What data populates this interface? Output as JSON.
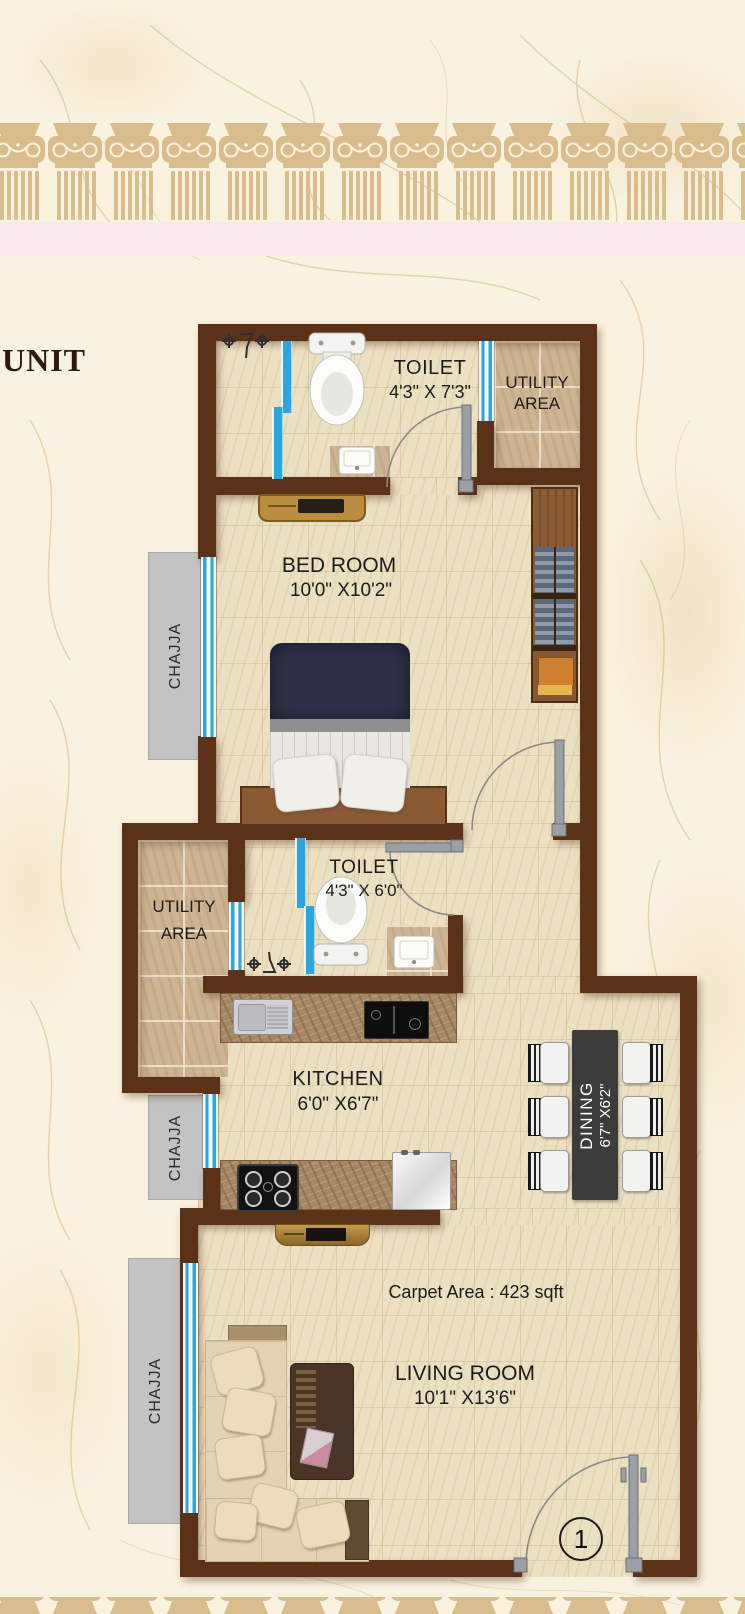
{
  "unit_label": "UNIT",
  "rooms": {
    "toilet_top": {
      "name": "TOILET",
      "dims": "4'3\" X 7'3\""
    },
    "utility_top": {
      "line1": "UTILITY",
      "line2": "AREA"
    },
    "bedroom": {
      "name": "BED ROOM",
      "dims": "10'0\" X10'2\""
    },
    "toilet_mid": {
      "name": "TOILET",
      "dims": "4'3\" X 6'0\""
    },
    "utility_mid": {
      "line1": "UTILITY",
      "line2": "AREA"
    },
    "kitchen": {
      "name": "KITCHEN",
      "dims": "6'0\" X6'7\""
    },
    "dining": {
      "name": "DINING",
      "dims": "6'7\" X6'2\""
    },
    "living": {
      "name": "LIVING ROOM",
      "dims": "10'1\" X13'6\""
    }
  },
  "chajja_labels": [
    "CHAJJA",
    "CHAJJA",
    "CHAJJA"
  ],
  "carpet_area_label": "Carpet Area : 423 sqft",
  "entry_door_number": "1",
  "colors": {
    "wall": "#5b3117",
    "window_blue": "#2aa7df",
    "chajja_gray": "#c3c3c3",
    "dining_table": "#3c3c3c",
    "floor_cream": "#ece0c3",
    "tile_tan": "#cdb492",
    "column_tan": "#d9bd8c",
    "pink_band": "#f8e9ec",
    "door_gray": "#9aa0a6"
  }
}
